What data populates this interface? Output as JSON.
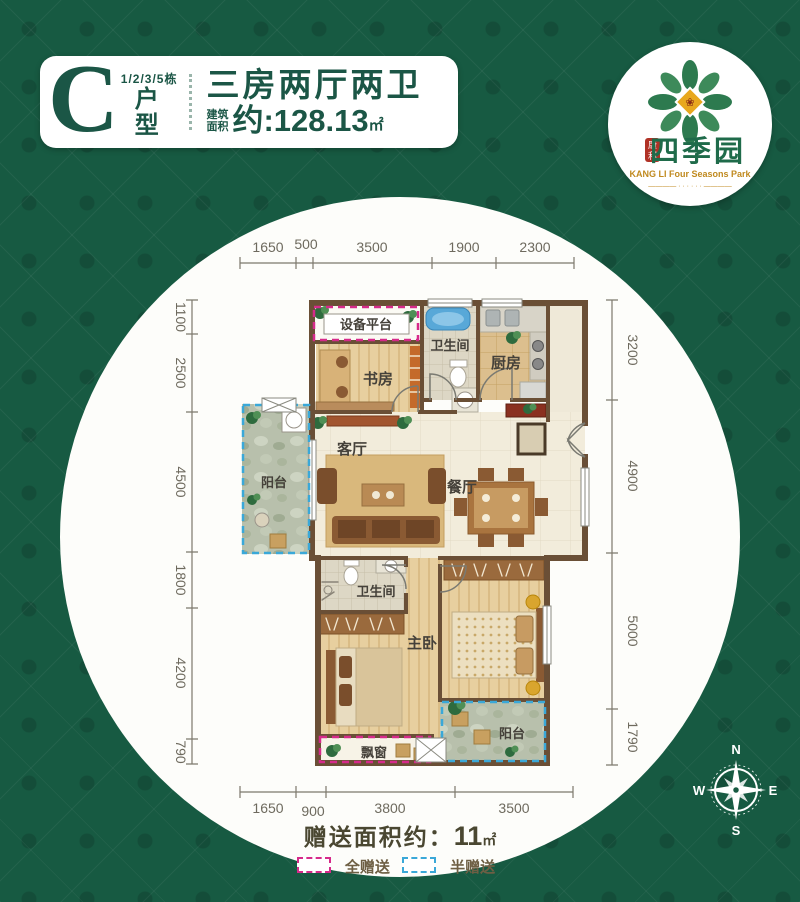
{
  "header": {
    "unit_letter": "C",
    "building": "1/2/3/5栋",
    "unit_label_1": "户",
    "unit_label_2": "型",
    "title": "三房两厅两卫",
    "area_label_1": "建筑",
    "area_label_2": "面积",
    "area_value": "约:128.13",
    "area_unit": "㎡"
  },
  "logo": {
    "brand": "四季园",
    "seal_top": "康",
    "seal_bottom": "利",
    "subtitle": "KANG LI Four Seasons Park",
    "tagline": "———— · · · · · · ————"
  },
  "dims": {
    "top": [
      "1650",
      "500",
      "3500",
      "1900",
      "2300"
    ],
    "bottom": [
      "1650",
      "900",
      "3800",
      "3500"
    ],
    "left": [
      "1100",
      "2500",
      "4500",
      "1800",
      "4200",
      "790"
    ],
    "right": [
      "3200",
      "4900",
      "5000",
      "1790"
    ]
  },
  "rooms": {
    "equipment_platform": "设备平台",
    "study": "书房",
    "bath_top": "卫生间",
    "kitchen": "厨房",
    "living": "客厅",
    "dining": "餐厅",
    "balcony_left": "阳台",
    "bath_lower": "卫生间",
    "master_bedroom": "主卧",
    "bay_window": "飘窗",
    "balcony_bottom": "阳台"
  },
  "footer": {
    "gift_label": "赠送面积约：",
    "gift_value": "11",
    "gift_unit": "㎡",
    "legend_full": "全赠送",
    "legend_half": "半赠送"
  },
  "compass": {
    "n": "N",
    "e": "E",
    "s": "S",
    "w": "W"
  },
  "colors": {
    "background_green": "#175a42",
    "brand_green": "#1b5646",
    "logo_gold": "#c08a1f",
    "full_gift_pink": "#d62a8a",
    "half_gift_blue": "#3aa8d8",
    "wall_brown": "#6a4f36",
    "dimension_gray": "#6e6a5e"
  }
}
